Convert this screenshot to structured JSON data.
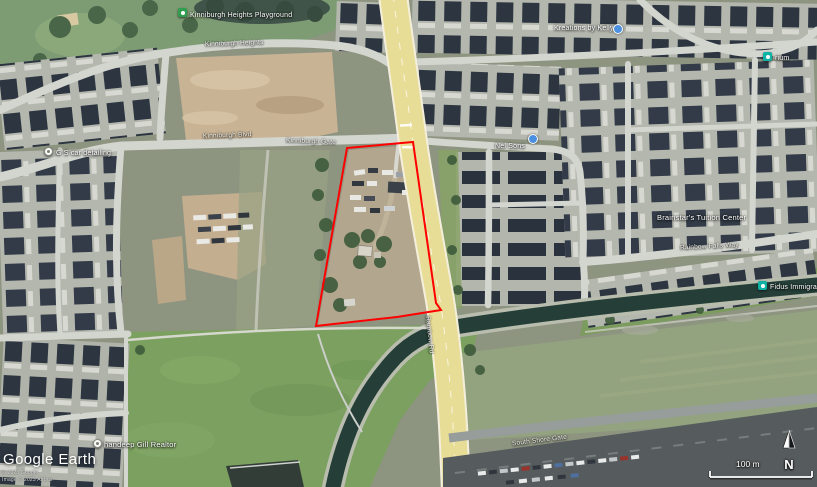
{
  "app": {
    "watermark": "Google Earth",
    "copyright_line1": "© 2023 Google",
    "copyright_line2": "Image © 2023 Airbus"
  },
  "places": {
    "playground": "Kinniburgh Heights Playground",
    "car_detailing": "G S car detailing",
    "nel_sons": "Nel Sons",
    "kreations": "Kreations by Kelly",
    "tuition_center": "Brainstar's Tuition Center",
    "fidus": "Fidus Immigra",
    "cropped_business": "rium",
    "realtor": "handeep Gill Realtor"
  },
  "streets": {
    "heights": "Kinniburgh Heights",
    "blvd": "Kinniburgh Blvd",
    "gate": "Kinniburgh Gate",
    "falls_way": "Rainbow Falls Way",
    "rainbow_rd": "Rainbow Rd",
    "south_shore": "South Shore Gate"
  },
  "hud": {
    "compass": "N",
    "scale": "100 m"
  },
  "annotation": {
    "name": "property-boundary",
    "color": "#ff0000"
  },
  "colors": {
    "marker_blue": "#4a8fe0",
    "marker_teal": "#0fb3a5",
    "park_green": "#2f9e4f"
  }
}
